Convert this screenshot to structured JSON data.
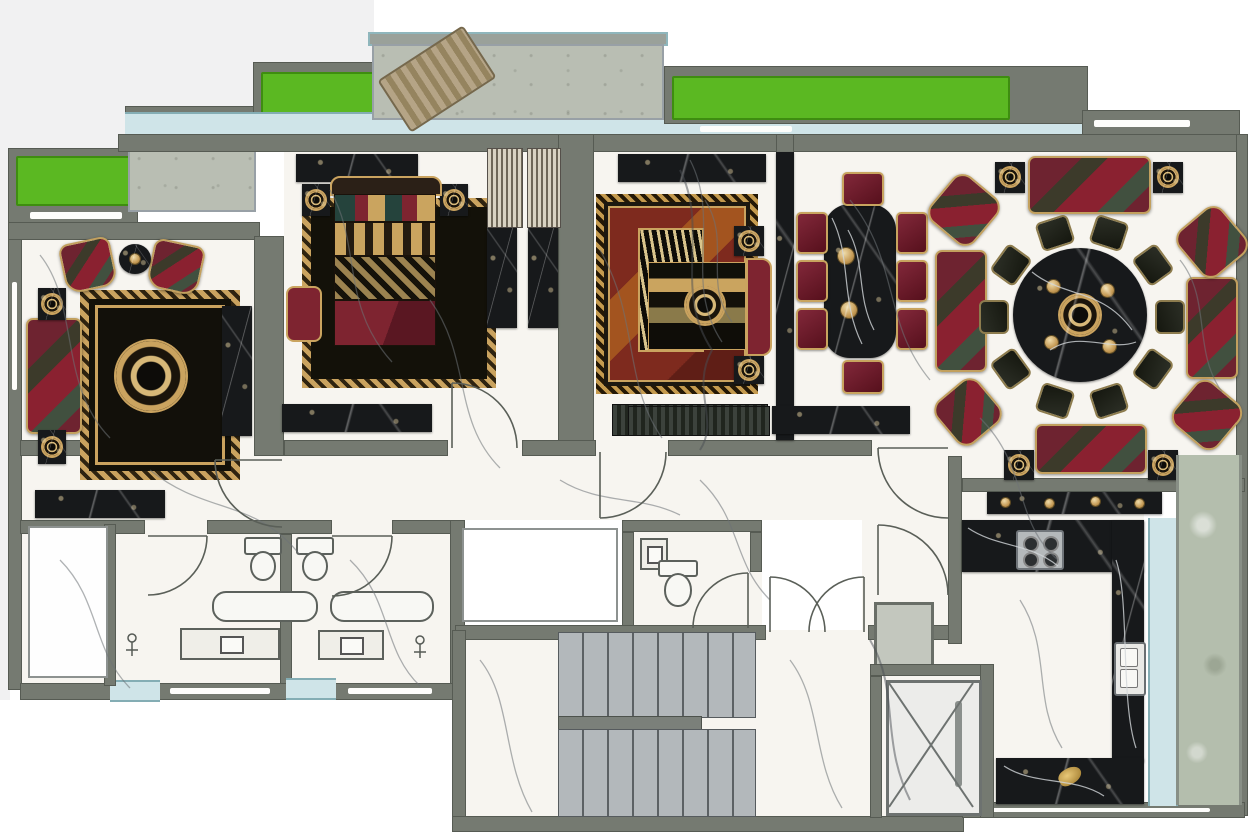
{
  "meta": {
    "title": "Luxury apartment furnished floor plan (top view interior rendering)",
    "plan_type": "residential-apartment",
    "decor_style": "classic black marble, gold and crimson baroque furniture",
    "canvas": {
      "width_px": 1248,
      "height_px": 832
    }
  },
  "palette": {
    "wall": "#757a71",
    "wall_dark": "#565b53",
    "wall_light": "#9aa19a",
    "floor_marble": "#f7f5f0",
    "marble_vein": "#6d7277",
    "balcony_concrete": "#b9beb3",
    "glass": "#cfe4e8",
    "glass_frame": "#84adb4",
    "planter_green": "#5bb822",
    "black_marble": "#17191b",
    "black_marble_vein": "#d2d6d9",
    "gold": "#c8a466",
    "crimson": "#7e2430",
    "stair_tread": "#b3b8bb",
    "service_glass": "#b4bead",
    "fixture_white": "#f8f8f4",
    "wood": "#b3a284"
  },
  "counts": {
    "majlis_round_table_chairs": 10,
    "dining_chairs": 8,
    "hob_burners": 4,
    "stair_flights": 2,
    "green_planters": 3,
    "bathrooms": 2
  },
  "rooms": [
    {
      "name": "living-room",
      "furniture": [
        {
          "item": "ornate-medallion-rug",
          "count": 1
        },
        {
          "item": "three-seat-sofa",
          "count": 1
        },
        {
          "item": "armchair",
          "count": 2
        },
        {
          "item": "round-side-table",
          "count": 1
        },
        {
          "item": "square-side-table",
          "count": 2
        },
        {
          "item": "black-marble-console",
          "count": 2
        }
      ]
    },
    {
      "name": "master-bedroom",
      "furniture": [
        {
          "item": "double-bed-with-headboard",
          "count": 1
        },
        {
          "item": "nightstand",
          "count": 2
        },
        {
          "item": "area-rug",
          "count": 1
        },
        {
          "item": "media-console",
          "count": 2
        },
        {
          "item": "wardrobe",
          "count": 2
        },
        {
          "item": "dresser",
          "count": 2
        },
        {
          "item": "side-bench",
          "count": 1
        }
      ]
    },
    {
      "name": "bedroom-2",
      "furniture": [
        {
          "item": "double-bed-with-headboard",
          "count": 1
        },
        {
          "item": "nightstand",
          "count": 2
        },
        {
          "item": "ornate-area-rug",
          "count": 1
        },
        {
          "item": "media-console",
          "count": 1
        },
        {
          "item": "foot-bench",
          "count": 1
        },
        {
          "item": "black-marble-tv-wall",
          "count": 1
        }
      ]
    },
    {
      "name": "dining-room",
      "furniture": [
        {
          "item": "black-marble-dining-table",
          "count": 1
        },
        {
          "item": "upholstered-dining-chair",
          "count": 8
        }
      ]
    },
    {
      "name": "majlis-family-lounge",
      "furniture": [
        {
          "item": "round-black-marble-table",
          "count": 1
        },
        {
          "item": "round-table-chair",
          "count": 10
        },
        {
          "item": "ornate-sofa",
          "count": 4
        },
        {
          "item": "corner-armchair",
          "count": 4
        },
        {
          "item": "square-side-table",
          "count": 4
        },
        {
          "item": "star-ornament",
          "count": 1
        }
      ]
    },
    {
      "name": "kitchen",
      "furniture": [
        {
          "item": "u-shaped-black-marble-counter",
          "count": 1
        },
        {
          "item": "gas-hob-4-burner",
          "count": 1
        },
        {
          "item": "double-bowl-sink",
          "count": 1
        },
        {
          "item": "bar-console",
          "count": 1
        },
        {
          "item": "service-balcony",
          "count": 1
        }
      ]
    },
    {
      "name": "bathroom-1",
      "furniture": [
        {
          "item": "bathtub",
          "count": 1
        },
        {
          "item": "vanity-sink",
          "count": 1
        },
        {
          "item": "wall-hung-toilet",
          "count": 1
        },
        {
          "item": "shower",
          "count": 1
        }
      ]
    },
    {
      "name": "bathroom-2",
      "furniture": [
        {
          "item": "bathtub",
          "count": 1
        },
        {
          "item": "vanity-sink",
          "count": 1
        },
        {
          "item": "wall-hung-toilet",
          "count": 1
        },
        {
          "item": "shower",
          "count": 1
        }
      ]
    },
    {
      "name": "powder-room",
      "furniture": [
        {
          "item": "toilet",
          "count": 1
        },
        {
          "item": "wash-basin",
          "count": 1
        }
      ]
    },
    {
      "name": "hallway",
      "furniture": [
        {
          "item": "black-marble-console",
          "count": 1
        },
        {
          "item": "striped-bench",
          "count": 1
        }
      ]
    },
    {
      "name": "stair-core",
      "furniture": [
        {
          "item": "staircase-flight",
          "count": 2
        },
        {
          "item": "elevator-car",
          "count": 1
        },
        {
          "item": "service-duct",
          "count": 1
        }
      ]
    },
    {
      "name": "balconies",
      "furniture": [
        {
          "item": "green-planter",
          "count": 3
        },
        {
          "item": "wooden-lounger",
          "count": 1
        },
        {
          "item": "concrete-deck",
          "count": 2
        },
        {
          "item": "window-band",
          "count": 1
        }
      ]
    },
    {
      "name": "storage-closet",
      "furniture": [
        {
          "item": "empty-closet",
          "count": 1
        }
      ]
    },
    {
      "name": "utility-room",
      "furniture": [
        {
          "item": "empty-room",
          "count": 1
        }
      ]
    }
  ],
  "doors": [
    "living-room-door",
    "master-bedroom-door",
    "bedroom-2-door",
    "bathroom-1-door",
    "bathroom-2-door",
    "powder-room-door",
    "stair-hall-double-door",
    "entry-door-upper",
    "entry-door-lower"
  ]
}
